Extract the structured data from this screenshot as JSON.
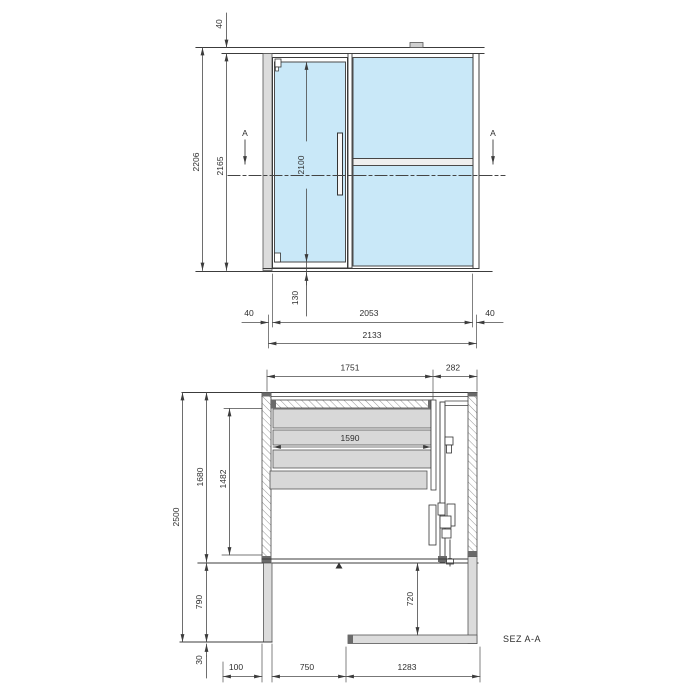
{
  "drawing": {
    "front_view": {
      "dim_top_offset": "40",
      "dim_total_height": "2206",
      "dim_clear_height": "2165",
      "dim_door_height": "2100",
      "dim_bottom_detail": "130",
      "dim_left_margin": "40",
      "dim_opening_width": "2053",
      "dim_right_margin": "40",
      "dim_total_width": "2133",
      "section_marker": "A"
    },
    "section_view": {
      "dim_panel_span": "1751",
      "dim_side_offset": "282",
      "dim_panel_width": "1590",
      "dim_total_height": "2500",
      "dim_upper_height": "1680",
      "dim_stack_height": "1482",
      "dim_lower_height": "790",
      "dim_passage_height": "720",
      "dim_base": "30",
      "dim_wall_thickness": "100",
      "dim_opening_depth": "750",
      "dim_floor_width": "1283",
      "caption": "SEZ A-A"
    },
    "colors": {
      "glass": "#c9e8f8",
      "panel": "#d8d8d8",
      "wall": "#dcdcdc",
      "cap": "#6a6a6a",
      "line": "#3c3c3c"
    }
  }
}
